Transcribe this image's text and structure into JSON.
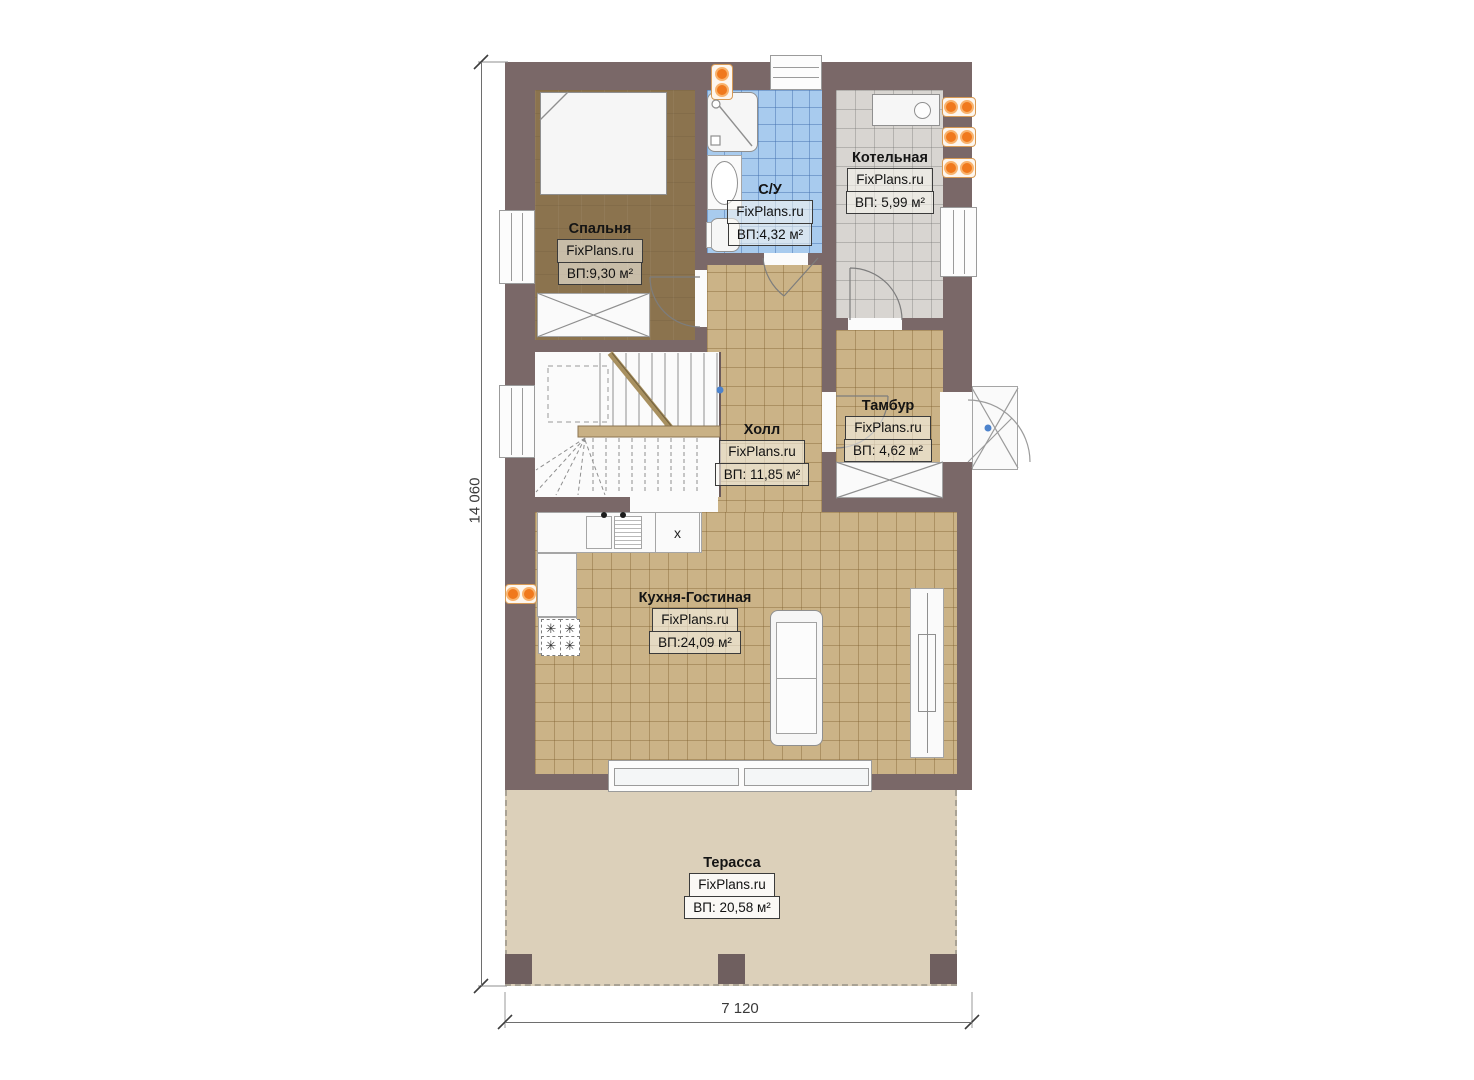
{
  "plan": {
    "watermark": "FixPlans.ru",
    "rooms": [
      {
        "id": "bedroom",
        "name": "Спальня",
        "area": "ВП:9,30 м²"
      },
      {
        "id": "bathroom",
        "name": "С/У",
        "area": "ВП:4,32 м²"
      },
      {
        "id": "boiler",
        "name": "Котельная",
        "area": "ВП: 5,99 м²"
      },
      {
        "id": "hall",
        "name": "Холл",
        "area": "ВП: 11,85 м²"
      },
      {
        "id": "tambour",
        "name": "Тамбур",
        "area": "ВП: 4,62 м²"
      },
      {
        "id": "kitchen",
        "name": "Кухня-Гостиная",
        "area": "ВП:24,09 м²"
      },
      {
        "id": "terrace",
        "name": "Терасса",
        "area": "ВП: 20,58 м²"
      }
    ],
    "dimensions": {
      "height": "14 060",
      "width": "7 120"
    },
    "markers": {
      "kitchen_unit": "х"
    },
    "icons": {
      "burner": "✳"
    },
    "colors": {
      "wall": "#7a6868",
      "bedroom_floor": "#8b734e",
      "bathroom_floor": "#a8cbee",
      "boiler_floor": "#d8d5d1",
      "hall_floor": "#cbb387",
      "terrace_floor": "#dcd0ba",
      "accent_orange": "#f0791d"
    }
  }
}
